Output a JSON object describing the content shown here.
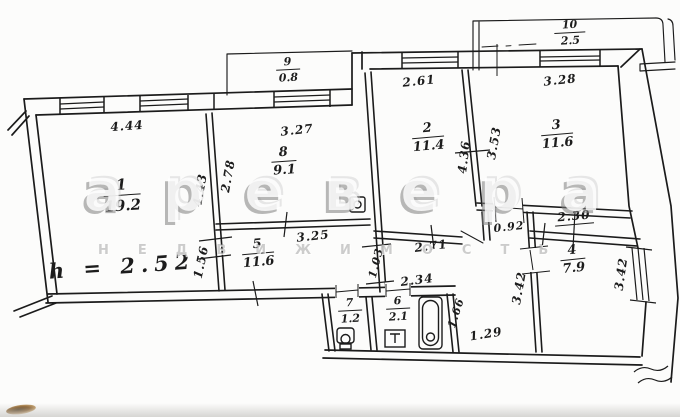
{
  "document": {
    "kind": "apartment floor plan (BTI technical drawing)",
    "height_note": "h = 2.52"
  },
  "watermark": {
    "brand": "аревера",
    "subtitle": "НЕДВИЖИМОСТЬ"
  },
  "colors": {
    "ink": "#1b1b1b",
    "paper": "#fcfcfb",
    "watermark": "#9a9a9a"
  },
  "rooms": [
    {
      "number": "1",
      "area": "19.2"
    },
    {
      "number": "2",
      "area": "11.4"
    },
    {
      "number": "3",
      "area": "11.6"
    },
    {
      "number": "4",
      "area": "7.9"
    },
    {
      "number": "5",
      "area": "11.6"
    },
    {
      "number": "6",
      "area": "2.1"
    },
    {
      "number": "7",
      "area": "1.2"
    },
    {
      "number": "8",
      "area": "9.1"
    },
    {
      "number": "9",
      "area": "0.8"
    },
    {
      "number": "10",
      "area": "2.5"
    }
  ],
  "dimensions": [
    {
      "text": "4.44"
    },
    {
      "text": "3.27"
    },
    {
      "text": "2.61"
    },
    {
      "text": "3.28"
    },
    {
      "text": "4.43"
    },
    {
      "text": "2.78"
    },
    {
      "text": "4.36"
    },
    {
      "text": "3.53"
    },
    {
      "text": "3.25"
    },
    {
      "text": "1.56"
    },
    {
      "text": "0.92"
    },
    {
      "text": "2.30"
    },
    {
      "text": "2.71"
    },
    {
      "text": "1.03"
    },
    {
      "text": "2.34"
    },
    {
      "text": "1.66"
    },
    {
      "text": "1.29"
    },
    {
      "text": "3.42"
    },
    {
      "text": "3.42"
    }
  ]
}
